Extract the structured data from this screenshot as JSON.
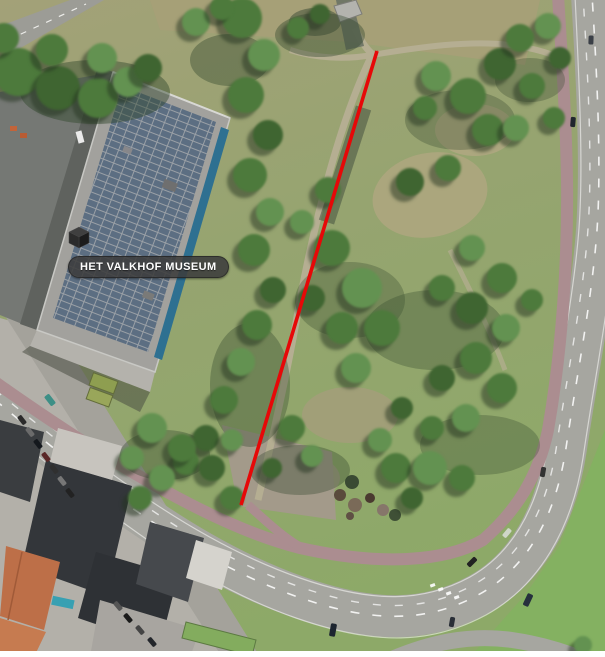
{
  "map": {
    "type": "aerial-satellite-view",
    "poi": {
      "label": "HET VALKHOF MUSEUM",
      "icon": "isometric-cube-icon"
    },
    "annotation_arrow": {
      "style": "double-headed",
      "color": "#e60808",
      "x1": 241,
      "y1": 505,
      "x2": 377,
      "y2": 51
    },
    "palette": {
      "arrow_red": "#e60808",
      "label_background": "#3c3c3c",
      "label_text": "#ffffff",
      "tree_green": "#4d7a3c",
      "grass_olive": "#9aa173",
      "road_gray": "#a6a6a0",
      "cycle_path_pink": "#ab8d90",
      "solar_panel_blue": "#5c6e82",
      "museum_roof_gray": "#a2a19d"
    }
  }
}
